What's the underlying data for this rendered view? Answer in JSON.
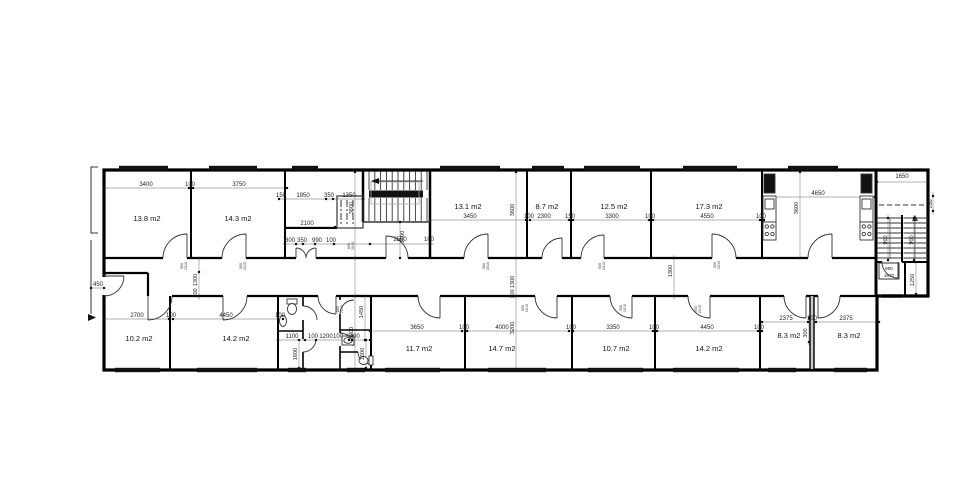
{
  "drawing": {
    "type": "architectural floor plan",
    "units": "mm",
    "rooms": [
      {
        "label": "13.8 m2",
        "x": 147,
        "y": 221
      },
      {
        "label": "14.3 m2",
        "x": 238,
        "y": 221
      },
      {
        "label": "13.1 m2",
        "x": 468,
        "y": 209
      },
      {
        "label": "8.7 m2",
        "x": 547,
        "y": 209
      },
      {
        "label": "12.5 m2",
        "x": 614,
        "y": 209
      },
      {
        "label": "17.3 m2",
        "x": 709,
        "y": 209
      },
      {
        "label": "10.2 m2",
        "x": 139,
        "y": 341
      },
      {
        "label": "14.2 m2",
        "x": 236,
        "y": 341
      },
      {
        "label": "11.7 m2",
        "x": 419,
        "y": 351
      },
      {
        "label": "14.7 m2",
        "x": 502,
        "y": 351
      },
      {
        "label": "10.7 m2",
        "x": 616,
        "y": 351
      },
      {
        "label": "14.2 m2",
        "x": 709,
        "y": 351
      },
      {
        "label": "8.3 m2",
        "x": 789,
        "y": 338
      },
      {
        "label": "8.3 m2",
        "x": 849,
        "y": 338
      }
    ],
    "dims_h": [
      {
        "t": "3400",
        "x": 146,
        "y": 186
      },
      {
        "t": "100",
        "x": 190,
        "y": 186
      },
      {
        "t": "3750",
        "x": 239,
        "y": 186
      },
      {
        "t": "150",
        "x": 281,
        "y": 197
      },
      {
        "t": "1950",
        "x": 303,
        "y": 197
      },
      {
        "t": "350",
        "x": 329,
        "y": 197
      },
      {
        "t": "1350",
        "x": 349,
        "y": 197
      },
      {
        "t": "2100",
        "x": 307,
        "y": 225
      },
      {
        "t": "800",
        "x": 290,
        "y": 242
      },
      {
        "t": "350",
        "x": 302,
        "y": 242
      },
      {
        "t": "990",
        "x": 317,
        "y": 242
      },
      {
        "t": "100",
        "x": 331,
        "y": 242
      },
      {
        "t": "2550",
        "x": 400,
        "y": 241
      },
      {
        "t": "100",
        "x": 429,
        "y": 241
      },
      {
        "t": "3450",
        "x": 470,
        "y": 218
      },
      {
        "t": "100",
        "x": 529,
        "y": 218
      },
      {
        "t": "2300",
        "x": 544,
        "y": 218
      },
      {
        "t": "150",
        "x": 570,
        "y": 218
      },
      {
        "t": "3300",
        "x": 612,
        "y": 218
      },
      {
        "t": "100",
        "x": 650,
        "y": 218
      },
      {
        "t": "4550",
        "x": 707,
        "y": 218
      },
      {
        "t": "100",
        "x": 761,
        "y": 218
      },
      {
        "t": "4650",
        "x": 818,
        "y": 195
      },
      {
        "t": "1650",
        "x": 902,
        "y": 178
      },
      {
        "t": "450",
        "x": 98,
        "y": 286
      },
      {
        "t": "2700",
        "x": 137,
        "y": 317
      },
      {
        "t": "100",
        "x": 171,
        "y": 317
      },
      {
        "t": "4450",
        "x": 226,
        "y": 317
      },
      {
        "t": "100",
        "x": 280,
        "y": 317
      },
      {
        "t": "1100",
        "x": 292,
        "y": 338
      },
      {
        "t": "100",
        "x": 313,
        "y": 338
      },
      {
        "t": "1200",
        "x": 326,
        "y": 338
      },
      {
        "t": "100",
        "x": 338,
        "y": 338
      },
      {
        "t": "1400",
        "x": 353,
        "y": 338
      },
      {
        "t": "3650",
        "x": 417,
        "y": 329
      },
      {
        "t": "100",
        "x": 464,
        "y": 329
      },
      {
        "t": "4000",
        "x": 502,
        "y": 329
      },
      {
        "t": "100",
        "x": 571,
        "y": 329
      },
      {
        "t": "3350",
        "x": 613,
        "y": 329
      },
      {
        "t": "100",
        "x": 654,
        "y": 329
      },
      {
        "t": "4450",
        "x": 707,
        "y": 329
      },
      {
        "t": "100",
        "x": 759,
        "y": 329
      },
      {
        "t": "2375",
        "x": 786,
        "y": 320
      },
      {
        "t": "100",
        "x": 812,
        "y": 320
      },
      {
        "t": "2375",
        "x": 846,
        "y": 320
      }
    ],
    "dims_v": [
      {
        "t": "3600",
        "x": 353,
        "y": 208
      },
      {
        "t": "3600",
        "x": 514,
        "y": 210
      },
      {
        "t": "3600",
        "x": 798,
        "y": 208
      },
      {
        "t": "1300",
        "x": 197,
        "y": 280
      },
      {
        "t": "100",
        "x": 197,
        "y": 293
      },
      {
        "t": "1300",
        "x": 514,
        "y": 282
      },
      {
        "t": "100",
        "x": 514,
        "y": 294
      },
      {
        "t": "1300",
        "x": 672,
        "y": 271
      },
      {
        "t": "3200",
        "x": 353,
        "y": 333
      },
      {
        "t": "3200",
        "x": 514,
        "y": 328
      },
      {
        "t": "1500",
        "x": 404,
        "y": 237
      },
      {
        "t": "1450",
        "x": 363,
        "y": 312
      },
      {
        "t": "1600",
        "x": 297,
        "y": 354
      },
      {
        "t": "1600",
        "x": 364,
        "y": 354
      },
      {
        "t": "300",
        "x": 807,
        "y": 333
      },
      {
        "t": "150",
        "x": 932,
        "y": 204
      },
      {
        "t": "900",
        "x": 887,
        "y": 240
      },
      {
        "t": "900",
        "x": 913,
        "y": 240
      },
      {
        "t": "1250",
        "x": 914,
        "y": 280
      }
    ],
    "door_tags": [
      {
        "a": "900",
        "b": "2010",
        "x": 183,
        "y": 266
      },
      {
        "a": "900",
        "b": "2010",
        "x": 242,
        "y": 266
      },
      {
        "a": "800",
        "b": "2010",
        "x": 350,
        "y": 246
      },
      {
        "a": "900",
        "b": "2010",
        "x": 485,
        "y": 266
      },
      {
        "a": "900",
        "b": "2010",
        "x": 601,
        "y": 266
      },
      {
        "a": "900",
        "b": "2010",
        "x": 716,
        "y": 265
      },
      {
        "a": "800",
        "b": "2010",
        "x": 339,
        "y": 309
      },
      {
        "a": "900",
        "b": "2010",
        "x": 524,
        "y": 308
      },
      {
        "a": "900",
        "b": "2010",
        "x": 622,
        "y": 308
      },
      {
        "a": "900",
        "b": "2010",
        "x": 697,
        "y": 309
      }
    ],
    "exit_door_tag": {
      "a": "800",
      "b": "1970"
    },
    "windows_top": [
      [
        119,
        49
      ],
      [
        209,
        48
      ],
      [
        292,
        26
      ],
      [
        440,
        60
      ],
      [
        532,
        32
      ],
      [
        584,
        56
      ],
      [
        683,
        54
      ],
      [
        788,
        50
      ]
    ],
    "windows_bottom": [
      [
        115,
        45
      ],
      [
        197,
        60
      ],
      [
        288,
        18
      ],
      [
        347,
        18
      ],
      [
        385,
        55
      ],
      [
        488,
        58
      ],
      [
        588,
        55
      ],
      [
        673,
        66
      ],
      [
        768,
        28
      ],
      [
        834,
        33
      ]
    ],
    "ticks_h": [
      {
        "y": 188,
        "xs": [
          104,
          189,
          193,
          287
        ]
      },
      {
        "y": 199,
        "xs": [
          279,
          285,
          326,
          333,
          363
        ]
      },
      {
        "y": 220,
        "xs": [
          430,
          526,
          530,
          569,
          573,
          649,
          653,
          760,
          764
        ]
      },
      {
        "y": 197,
        "xs": [
          762,
          875
        ]
      },
      {
        "y": 244,
        "xs": [
          285,
          296,
          303,
          315,
          334,
          370,
          430
        ]
      },
      {
        "y": 227,
        "xs": [
          285,
          335
        ]
      },
      {
        "y": 182,
        "xs": [
          877,
          928
        ]
      },
      {
        "y": 288,
        "xs": [
          91,
          104
        ]
      },
      {
        "y": 319,
        "xs": [
          104,
          169,
          173,
          278,
          283
        ]
      },
      {
        "y": 340,
        "xs": [
          278,
          305,
          316,
          349,
          352,
          370
        ]
      },
      {
        "y": 331,
        "xs": [
          370,
          462,
          467,
          569,
          573,
          653,
          657,
          758,
          762
        ]
      },
      {
        "y": 322,
        "xs": [
          762,
          808,
          816,
          879
        ]
      }
    ],
    "ticks_v": [
      {
        "x": 355,
        "ys": [
          172,
          258,
          296,
          370
        ]
      },
      {
        "x": 516,
        "ys": [
          172,
          258,
          296,
          370
        ]
      },
      {
        "x": 199,
        "ys": [
          258,
          272,
          296
        ]
      },
      {
        "x": 800,
        "ys": [
          172,
          258
        ]
      },
      {
        "x": 674,
        "ys": [
          258,
          296
        ]
      },
      {
        "x": 400,
        "ys": [
          222,
          258
        ]
      },
      {
        "x": 933,
        "ys": [
          196,
          211
        ]
      },
      {
        "x": 888,
        "ys": [
          218,
          260
        ]
      },
      {
        "x": 914,
        "ys": [
          218,
          260
        ]
      },
      {
        "x": 916,
        "ys": [
          262,
          294
        ]
      },
      {
        "x": 365,
        "ys": [
          296,
          340
        ]
      },
      {
        "x": 299,
        "ys": [
          340,
          368
        ]
      },
      {
        "x": 366,
        "ys": [
          340,
          368
        ]
      },
      {
        "x": 809,
        "ys": [
          318,
          342
        ]
      }
    ],
    "colors": {
      "wall": "#000000",
      "dim_text": "#222222",
      "chain": "#b2b2b2",
      "window": "#111111"
    }
  }
}
